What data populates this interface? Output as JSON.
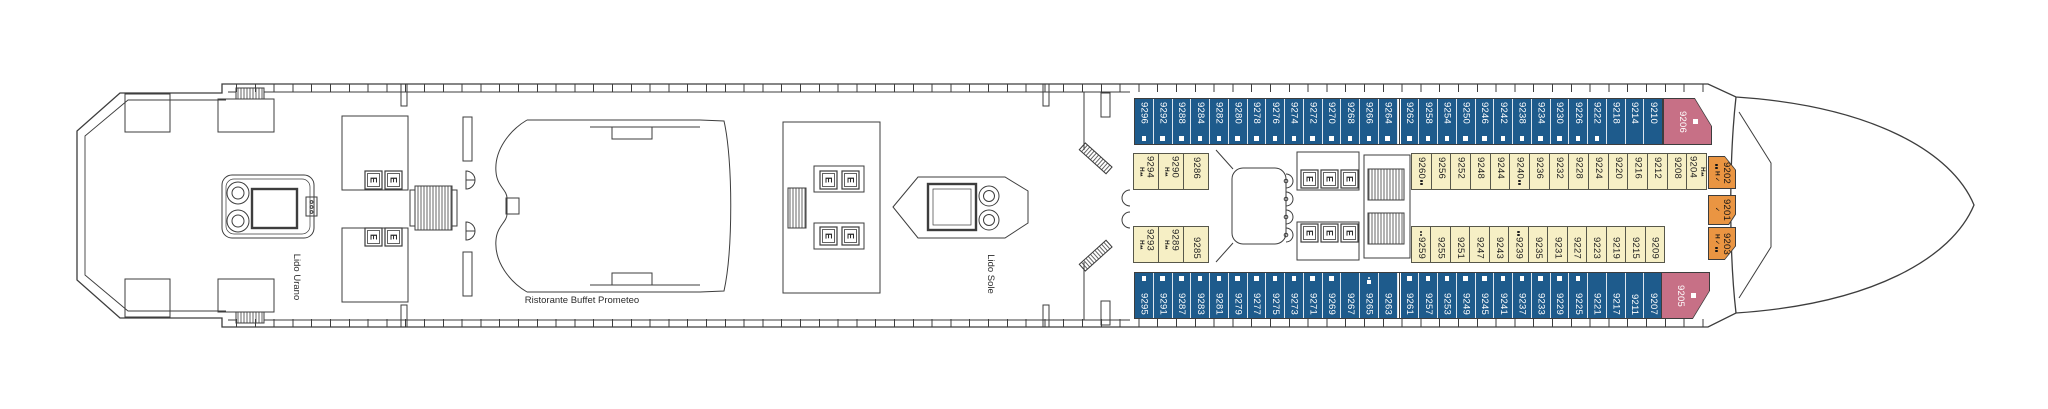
{
  "deck_plan": {
    "venues": {
      "lido_urano": "Lido Urano",
      "buffet": "Ristorante Buffet Prometeo",
      "lido_sole": "Lido Sole"
    },
    "elevator_label": "E",
    "colors": {
      "balcony_cabin_blue": "#1e5b8c",
      "inside_cabin_cream": "#f6efc5",
      "suite_pink": "#c77086",
      "suite_orange": "#ea9542",
      "line": "#3d3d3d"
    },
    "symbols": {
      "sq": "white-square",
      "dot": "dot",
      "dots": "two-dots",
      "h": "H",
      "tri": "two-triangles",
      "chk": "check"
    },
    "rows": {
      "top_outer": [
        {
          "n": "9296",
          "marks": [
            "sq"
          ]
        },
        {
          "n": "9292",
          "marks": [
            "sq"
          ]
        },
        {
          "n": "9288",
          "marks": [
            "sq"
          ]
        },
        {
          "n": "9284",
          "marks": [
            "sq"
          ]
        },
        {
          "n": "9282",
          "marks": [
            "sq"
          ]
        },
        {
          "n": "9280",
          "marks": [
            "sq"
          ]
        },
        {
          "n": "9278",
          "marks": [
            "sq"
          ]
        },
        {
          "n": "9276",
          "marks": [
            "sq"
          ]
        },
        {
          "n": "9274",
          "marks": [
            "sq"
          ]
        },
        {
          "n": "9272",
          "marks": [
            "sq"
          ]
        },
        {
          "n": "9270",
          "marks": [
            "sq"
          ]
        },
        {
          "n": "9268",
          "marks": [
            "sq"
          ]
        },
        {
          "n": "9266",
          "marks": [
            "sq"
          ]
        },
        {
          "n": "9264",
          "marks": [
            "sq"
          ]
        },
        {
          "n": "9262",
          "marks": [
            "sq"
          ]
        },
        {
          "n": "9258",
          "marks": [
            "sq"
          ]
        },
        {
          "n": "9254",
          "marks": [
            "sq"
          ]
        },
        {
          "n": "9250",
          "marks": [
            "sq"
          ]
        },
        {
          "n": "9246",
          "marks": [
            "sq"
          ]
        },
        {
          "n": "9242",
          "marks": [
            "sq"
          ]
        },
        {
          "n": "9238",
          "marks": [
            "sq"
          ]
        },
        {
          "n": "9234",
          "marks": [
            "sq"
          ]
        },
        {
          "n": "9230",
          "marks": [
            "sq"
          ]
        },
        {
          "n": "9226",
          "marks": [
            "sq"
          ]
        },
        {
          "n": "9222",
          "marks": [
            "sq"
          ]
        },
        {
          "n": "9218",
          "marks": []
        },
        {
          "n": "9214",
          "marks": []
        },
        {
          "n": "9210",
          "marks": []
        }
      ],
      "bottom_outer": [
        {
          "n": "9295",
          "marks": [
            "sq"
          ]
        },
        {
          "n": "9291",
          "marks": [
            "sq"
          ]
        },
        {
          "n": "9287",
          "marks": [
            "sq"
          ]
        },
        {
          "n": "9283",
          "marks": [
            "sq"
          ]
        },
        {
          "n": "9281",
          "marks": [
            "sq"
          ]
        },
        {
          "n": "9279",
          "marks": [
            "sq"
          ]
        },
        {
          "n": "9277",
          "marks": [
            "sq"
          ]
        },
        {
          "n": "9275",
          "marks": [
            "sq"
          ]
        },
        {
          "n": "9273",
          "marks": [
            "sq"
          ]
        },
        {
          "n": "9271",
          "marks": [
            "sq"
          ]
        },
        {
          "n": "9269",
          "marks": [
            "sq"
          ]
        },
        {
          "n": "9267",
          "marks": []
        },
        {
          "n": "9265",
          "marks": [
            "dot",
            "sq"
          ]
        },
        {
          "n": "9263",
          "marks": []
        },
        {
          "n": "9261",
          "marks": [
            "sq"
          ]
        },
        {
          "n": "9257",
          "marks": [
            "sq"
          ]
        },
        {
          "n": "9253",
          "marks": [
            "sq"
          ]
        },
        {
          "n": "9249",
          "marks": [
            "sq"
          ]
        },
        {
          "n": "9245",
          "marks": [
            "sq"
          ]
        },
        {
          "n": "9241",
          "marks": [
            "sq"
          ]
        },
        {
          "n": "9237",
          "marks": [
            "sq"
          ]
        },
        {
          "n": "9233",
          "marks": [
            "sq"
          ]
        },
        {
          "n": "9229",
          "marks": [
            "sq"
          ]
        },
        {
          "n": "9225",
          "marks": [
            "sq"
          ]
        },
        {
          "n": "9221",
          "marks": []
        },
        {
          "n": "9217",
          "marks": []
        },
        {
          "n": "9211",
          "marks": []
        },
        {
          "n": "9207",
          "marks": []
        }
      ],
      "top_inner_aft": [
        {
          "n": "9294",
          "marks": [
            "h",
            "tri"
          ],
          "markSide": "left"
        },
        {
          "n": "9290",
          "marks": [
            "h",
            "tri"
          ],
          "markSide": "left"
        },
        {
          "n": "9286",
          "marks": []
        }
      ],
      "bottom_inner_aft": [
        {
          "n": "9293",
          "marks": [
            "h",
            "tri"
          ],
          "markSide": "left"
        },
        {
          "n": "9289",
          "marks": [
            "h",
            "tri"
          ],
          "markSide": "left"
        },
        {
          "n": "9285",
          "marks": []
        }
      ],
      "top_inner_fwd": [
        {
          "n": "9260",
          "marks": [
            "dots"
          ]
        },
        {
          "n": "9256",
          "marks": []
        },
        {
          "n": "9252",
          "marks": []
        },
        {
          "n": "9248",
          "marks": []
        },
        {
          "n": "9244",
          "marks": []
        },
        {
          "n": "9240",
          "marks": [
            "dots"
          ]
        },
        {
          "n": "9236",
          "marks": []
        },
        {
          "n": "9232",
          "marks": []
        },
        {
          "n": "9228",
          "marks": []
        },
        {
          "n": "9224",
          "marks": []
        },
        {
          "n": "9220",
          "marks": []
        },
        {
          "n": "9216",
          "marks": []
        },
        {
          "n": "9212",
          "marks": []
        },
        {
          "n": "9208",
          "marks": []
        },
        {
          "n": "9204",
          "marks": [
            "h",
            "tri"
          ],
          "markSide": "right"
        }
      ],
      "bottom_inner_fwd": [
        {
          "n": "9259",
          "marks": [
            "dots"
          ]
        },
        {
          "n": "9255",
          "marks": []
        },
        {
          "n": "9251",
          "marks": []
        },
        {
          "n": "9247",
          "marks": []
        },
        {
          "n": "9243",
          "marks": []
        },
        {
          "n": "9239",
          "marks": [
            "dots"
          ]
        },
        {
          "n": "9235",
          "marks": []
        },
        {
          "n": "9231",
          "marks": []
        },
        {
          "n": "9227",
          "marks": []
        },
        {
          "n": "9223",
          "marks": []
        },
        {
          "n": "9219",
          "marks": []
        },
        {
          "n": "9215",
          "marks": []
        },
        {
          "n": "9209",
          "marks": []
        }
      ]
    },
    "specials": [
      {
        "n": "9206",
        "marks": [
          "sq"
        ],
        "style": "pink"
      },
      {
        "n": "9205",
        "marks": [
          "sq"
        ],
        "style": "pink"
      },
      {
        "n": "9202",
        "marks": [
          "dots",
          "h",
          "chk"
        ],
        "style": "orange"
      },
      {
        "n": "9201",
        "marks": [
          "chk"
        ],
        "style": "orange"
      },
      {
        "n": "9203",
        "marks": [
          "h",
          "chk",
          "dots"
        ],
        "style": "orange"
      }
    ]
  }
}
